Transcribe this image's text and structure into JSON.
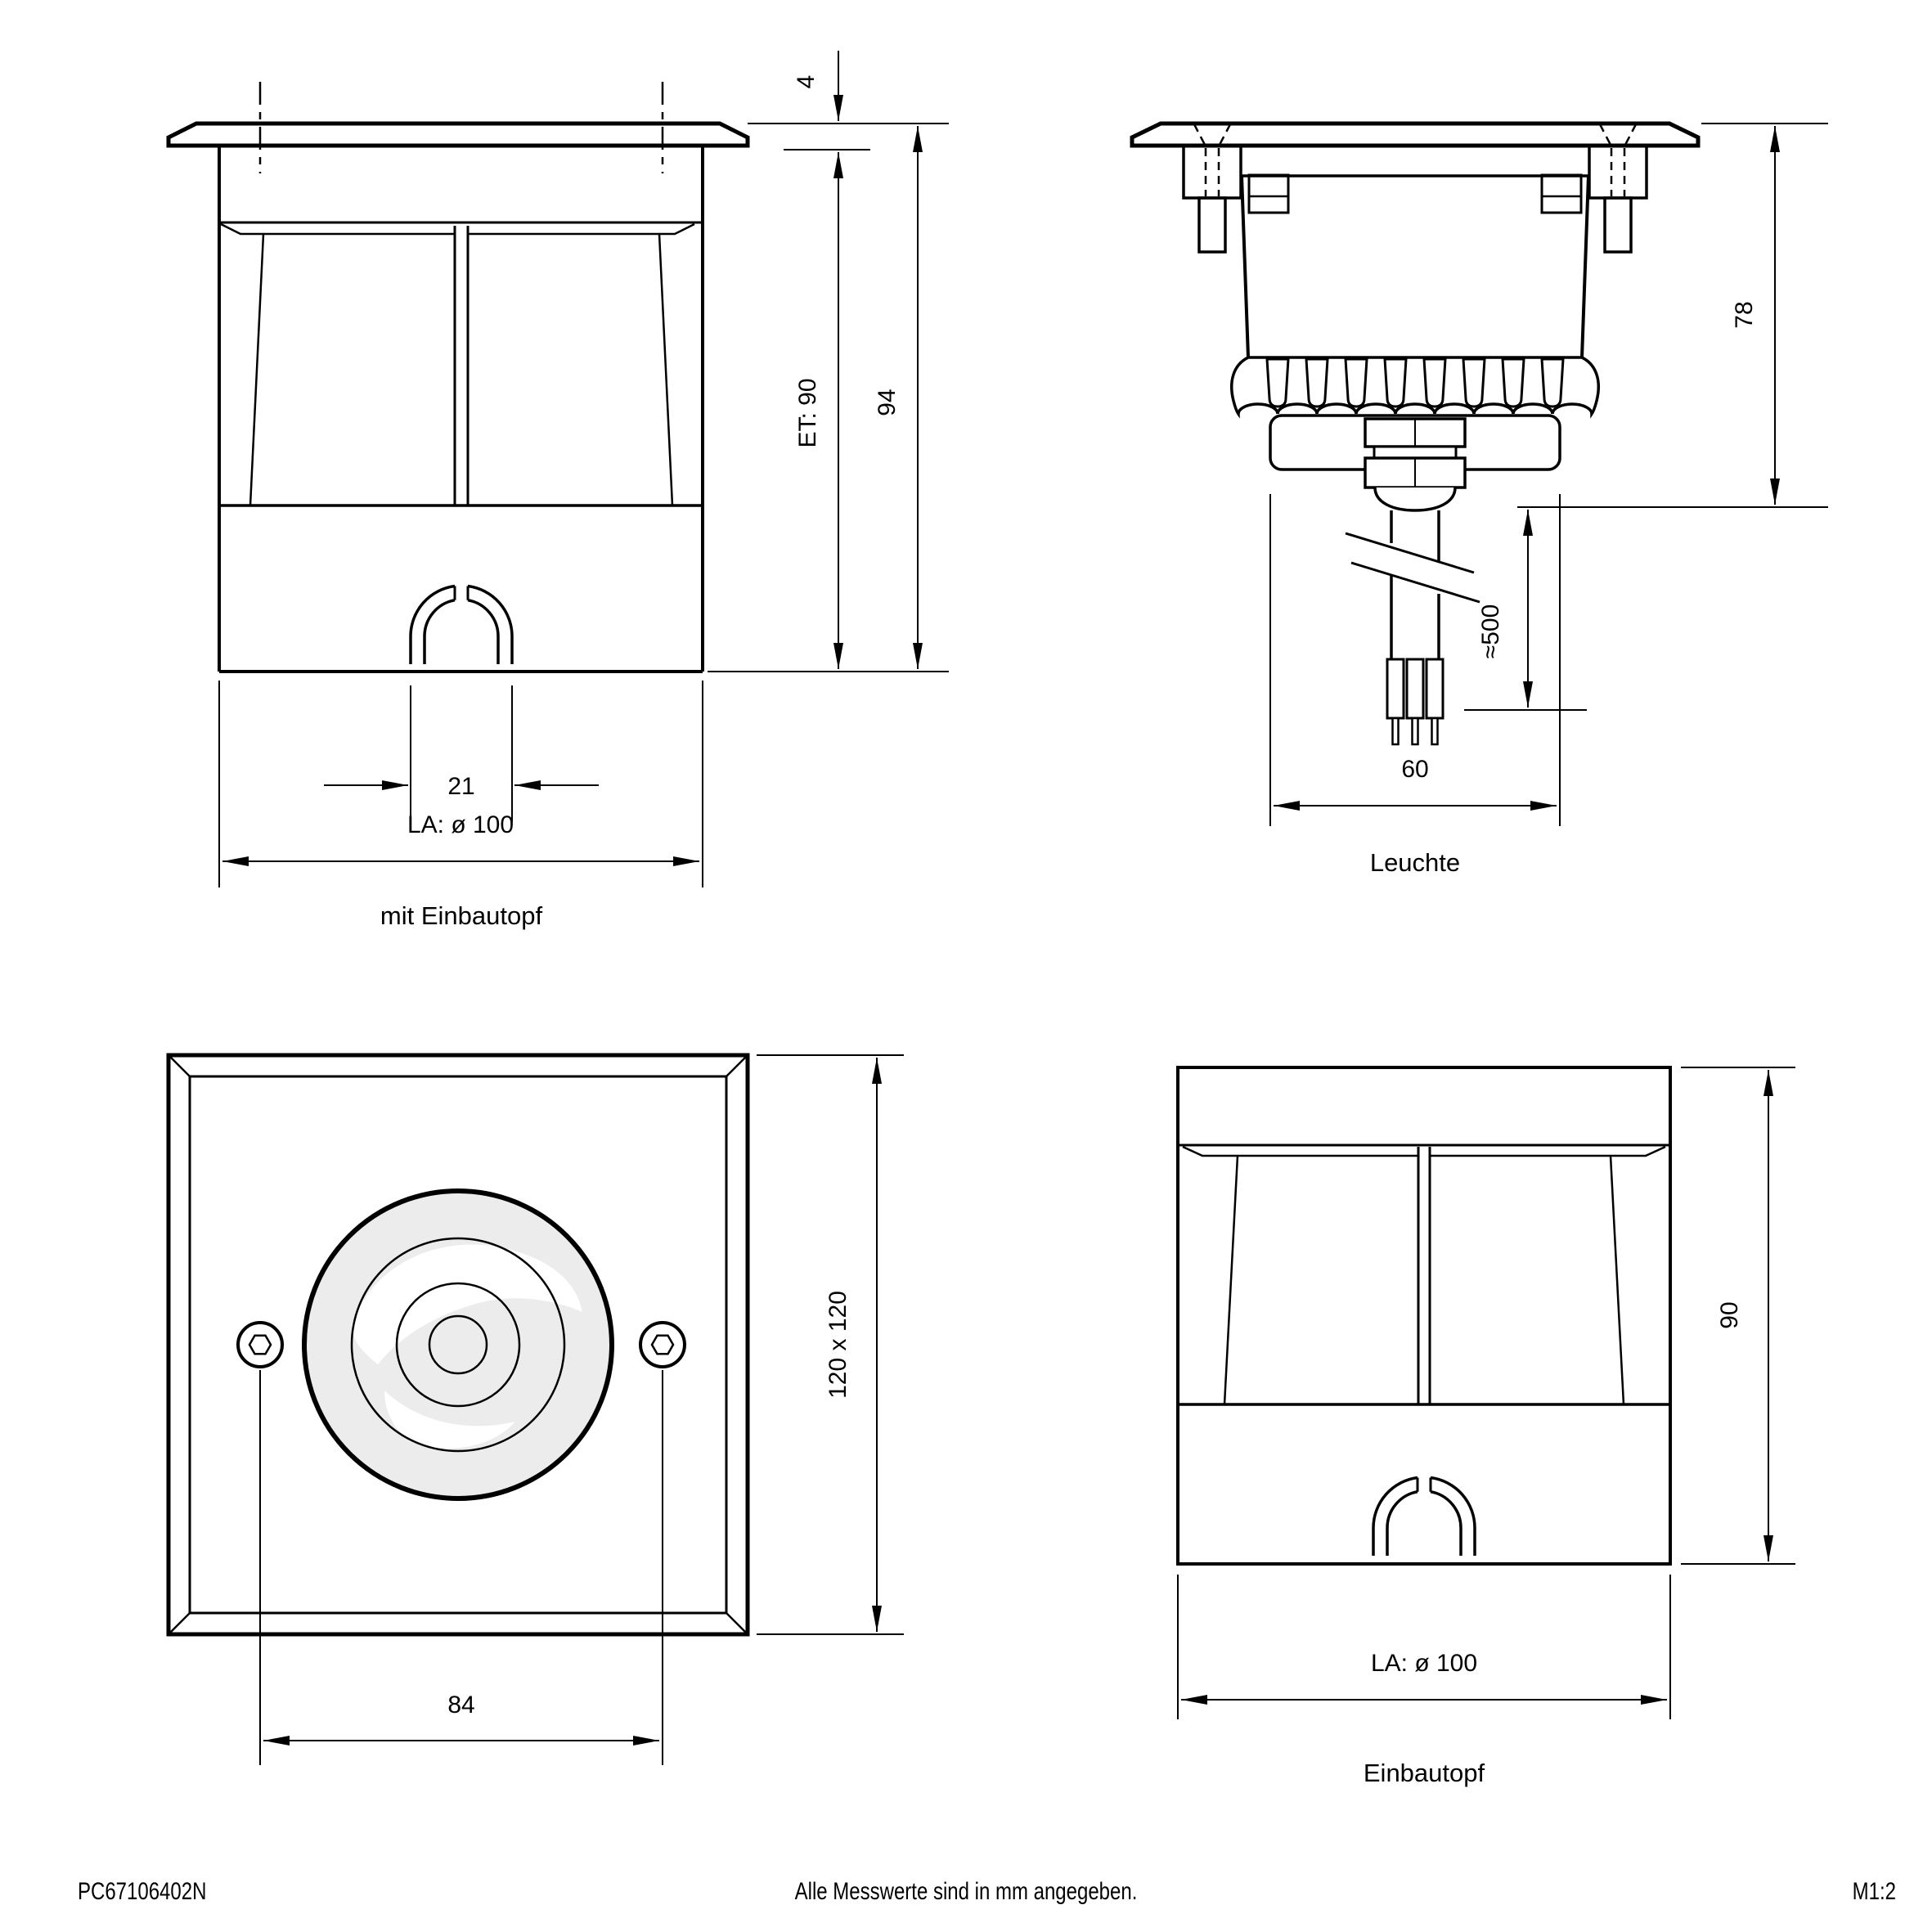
{
  "drawing": {
    "footer": {
      "doc_number": "PC67106402N",
      "note": "Alle Messwerte sind in mm angegeben.",
      "scale": "M1:2"
    },
    "colors": {
      "line": "#000000",
      "lens_fill": "#ececec",
      "background": "#ffffff"
    },
    "views": {
      "side_with_pot": {
        "caption": "mit Einbautopf",
        "dims": {
          "flange_height": "4",
          "recess_depth": "ET: 90",
          "total_height": "94",
          "cable_entry_width": "21",
          "cutout_diameter": "LA: ø 100"
        }
      },
      "luminaire": {
        "caption": "Leuchte",
        "dims": {
          "height": "78",
          "cable_length": "≈500",
          "body_diameter": "60"
        }
      },
      "front_face": {
        "dims": {
          "screw_spacing": "84",
          "plate_size": "120 x 120"
        }
      },
      "pot": {
        "caption": "Einbautopf",
        "dims": {
          "height": "90",
          "cutout_diameter": "LA: ø 100"
        }
      }
    }
  }
}
